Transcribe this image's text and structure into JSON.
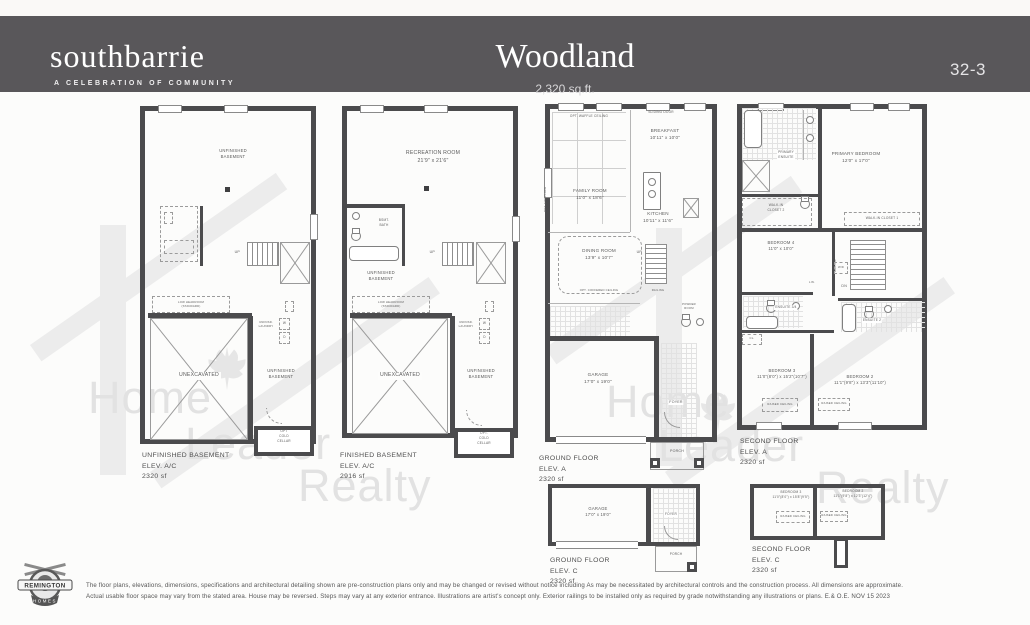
{
  "header": {
    "logo": "southbarrie",
    "tagline": "A CELEBRATION OF COMMUNITY",
    "title": "Woodland",
    "sqft": "2,320 sq.ft.",
    "lot_number": "32-3"
  },
  "watermark": {
    "word1": "Home",
    "word2": "Leader",
    "word3": "Realty"
  },
  "plans": {
    "unfinished_basement": {
      "caption": "UNFINISHED BASEMENT\nELEV. A/C\n2320 sf",
      "labels": {
        "main": "UNFINISHED\nBASEMENT",
        "low_headroom": "LOW HEADROOM\n(STANDARD)",
        "unexcavated": "UNEXCAVATED",
        "side": "UNFINISHED\nBASEMENT",
        "cold_cellar": "OPT\nCOLD\nCELLAR",
        "laundry": "UNFNSD.\nLAUNDRY",
        "washer": "W",
        "dryer": "D",
        "tub": "TUB",
        "up": "UP"
      }
    },
    "finished_basement": {
      "caption": "FINISHED BASEMENT\nELEV. A/C\n2916 sf",
      "labels": {
        "recreation": "RECREATION ROOM\n21'9\" x 21'6\"",
        "bsmt_bath": "BSMT.\nBATH",
        "unfinished": "UNFINISHED\nBASEMENT",
        "low_headroom": "LOW HEADROOM\n(STANDARD)",
        "unexcavated": "UNEXCAVATED",
        "side": "UNFINISHED\nBASEMENT",
        "cold_cellar": "OPT.\nCOLD\nCELLAR",
        "laundry": "UNFNSD.\nLAUNDRY",
        "washer": "W",
        "dryer": "D",
        "tub": "TUB",
        "up": "UP"
      }
    },
    "ground_floor_a": {
      "caption": "GROUND FLOOR\nELEV. A\n2320 sf",
      "labels": {
        "waffle": "OPT. WAFFLE CEILING",
        "sliding_door": "SLIDING DOOR",
        "family": "FAMILY ROOM\n11'0\" x 18'6\"",
        "breakfast": "BREAKFAST\n10'11\" x 10'0\"",
        "kitchen": "KITCHEN\n10'11\" x 11'6\"",
        "dining": "DINING ROOM\n13'9\" x 10'7\"",
        "coffered": "OPT. COFFERED CEILING",
        "garage": "GARAGE\n17'0\" x 19'0\"",
        "foyer": "FOYER",
        "porch": "PORCH",
        "powder": "POWDER\nROOM",
        "up": "UP",
        "railing": "RAILING",
        "fireplace": "OPT. FIREPLACE"
      }
    },
    "second_floor_a": {
      "caption": "SECOND FLOOR\nELEV. A\n2320 sf",
      "labels": {
        "primary_bedroom": "PRIMARY BEDROOM\n12'0\" x 17'0\"",
        "primary_ensuite": "PRIMARY\nENSUITE",
        "wic2": "WALK-IN\nCLOSET 2",
        "wic1": "WALK-IN CLOSET 1",
        "bedroom4": "BEDROOM 4\n11'0\" x 10'0\"",
        "ensuite34": "ENSUITE 3/4",
        "ensuite2": "ENSUITE 2",
        "bedroom3": "BEDROOM 3\n11'0\"(8'0\") x 15'2\"(10'7\")",
        "bedroom2": "BEDROOM 2\n11'1\"(9'8\") x 13'3\"(11'10\")",
        "raised_ceiling": "RAISED CEILING",
        "dn": "DN",
        "wd": "W/D",
        "lin": "LIN.",
        "cl": "CL.",
        "railing": "RAILING"
      }
    },
    "ground_floor_c": {
      "caption": "GROUND FLOOR\nELEV. C\n2320 sf",
      "labels": {
        "garage": "GARAGE\n17'0\" x 19'0\"",
        "foyer": "FOYER",
        "porch": "PORCH"
      }
    },
    "second_floor_c": {
      "caption": "SECOND FLOOR\nELEV. C\n2320 sf",
      "labels": {
        "bedroom3": "BEDROOM 3\n11'0\"(8'0\") x 15'8\"(9'5\")",
        "bedroom2": "BEDROOM 2\n11'1\"(9'8\") x 12'3\"(12'4\")",
        "raised_ceiling": "RAISED CEILING"
      }
    }
  },
  "footer": {
    "builder_top": "REMINGTON",
    "builder_bottom": "HOMES",
    "disclaimer_line1": "The floor plans, elevations, dimensions, specifications and architectural detailing shown are pre-construction plans only and may be changed or revised without notice including As may be necessitated by architectural controls and the construction process. All dimensions are approximate.",
    "disclaimer_line2": "Actual usable floor space may vary from the stated area. House may be reversed. Steps may vary at any exterior entrance. Illustrations are artist's concept only. Exterior railings to be installed only as required by grade notwithstanding any illustrations or plans. E.& O.E. NOV 15 2023"
  },
  "colors": {
    "header_bg": "#59575a",
    "wall": "#4b4b4d",
    "watermark": "#e2e2e2"
  }
}
